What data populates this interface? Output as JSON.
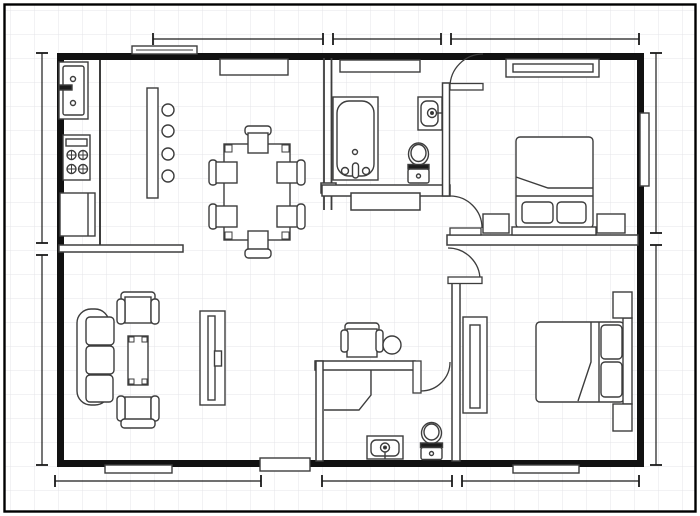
{
  "document": {
    "type": "floor-plan-drawing",
    "canvas_width_px": 700,
    "canvas_height_px": 516,
    "grid_size_px": 24,
    "text_labels_visible": false
  },
  "colors": {
    "background": "#ffffff",
    "grid": "#e4e4e8",
    "page_border": "#000000",
    "wall": "#111111",
    "line": "#3d3d3d",
    "dark": "#1c1c1c",
    "fill": "#ffffff",
    "dimension": "#1a1a1a"
  },
  "rooms": [
    {
      "name": "kitchen",
      "furniture": [
        "sink counter",
        "range with 4 burners",
        "refrigerator",
        "island counter",
        "4 bar stools"
      ]
    },
    {
      "name": "dining-area",
      "furniture": [
        "rectangular dining table",
        "6 chairs",
        "window shelf"
      ]
    },
    {
      "name": "bathroom-1",
      "furniture": [
        "bathtub",
        "wall sink",
        "toilet",
        "linen closet"
      ]
    },
    {
      "name": "bedroom-1",
      "furniture": [
        "double bed",
        "2 pillows",
        "headboard",
        "2 nightstands",
        "window"
      ]
    },
    {
      "name": "living-room",
      "furniture": [
        "3-seat sofa",
        "2 armchairs",
        "coffee table",
        "tv console"
      ]
    },
    {
      "name": "office-nook",
      "furniture": [
        "desk chair",
        "round stool"
      ]
    },
    {
      "name": "bathroom-2",
      "furniture": [
        "corner shower",
        "vanity sink",
        "toilet"
      ]
    },
    {
      "name": "bedroom-2",
      "furniture": [
        "double bed",
        "2 pillows",
        "headboard",
        "2 nightstands",
        "wardrobe"
      ]
    },
    {
      "name": "hallway",
      "furniture": [
        "door swings"
      ]
    }
  ],
  "openings": {
    "window_count": 6,
    "door_swing_count": 4,
    "entry_opening_count": 1
  },
  "dimension_lines": {
    "labels_visible": false,
    "top": {
      "axis": "horizontal",
      "y_px": 39,
      "segments_px": [
        [
          153,
          323
        ],
        [
          333,
          441
        ],
        [
          451,
          639
        ]
      ]
    },
    "left": {
      "axis": "vertical",
      "x_px": 42,
      "segments_px": [
        [
          53,
          243
        ],
        [
          255,
          465
        ]
      ]
    },
    "right": {
      "axis": "vertical",
      "x_px": 656,
      "segments_px": [
        [
          53,
          233
        ],
        [
          245,
          465
        ]
      ]
    },
    "bottom": {
      "axis": "horizontal",
      "y_px": 481,
      "segments_px": [
        [
          55,
          261
        ],
        [
          322,
          452
        ],
        [
          462,
          639
        ]
      ]
    }
  }
}
